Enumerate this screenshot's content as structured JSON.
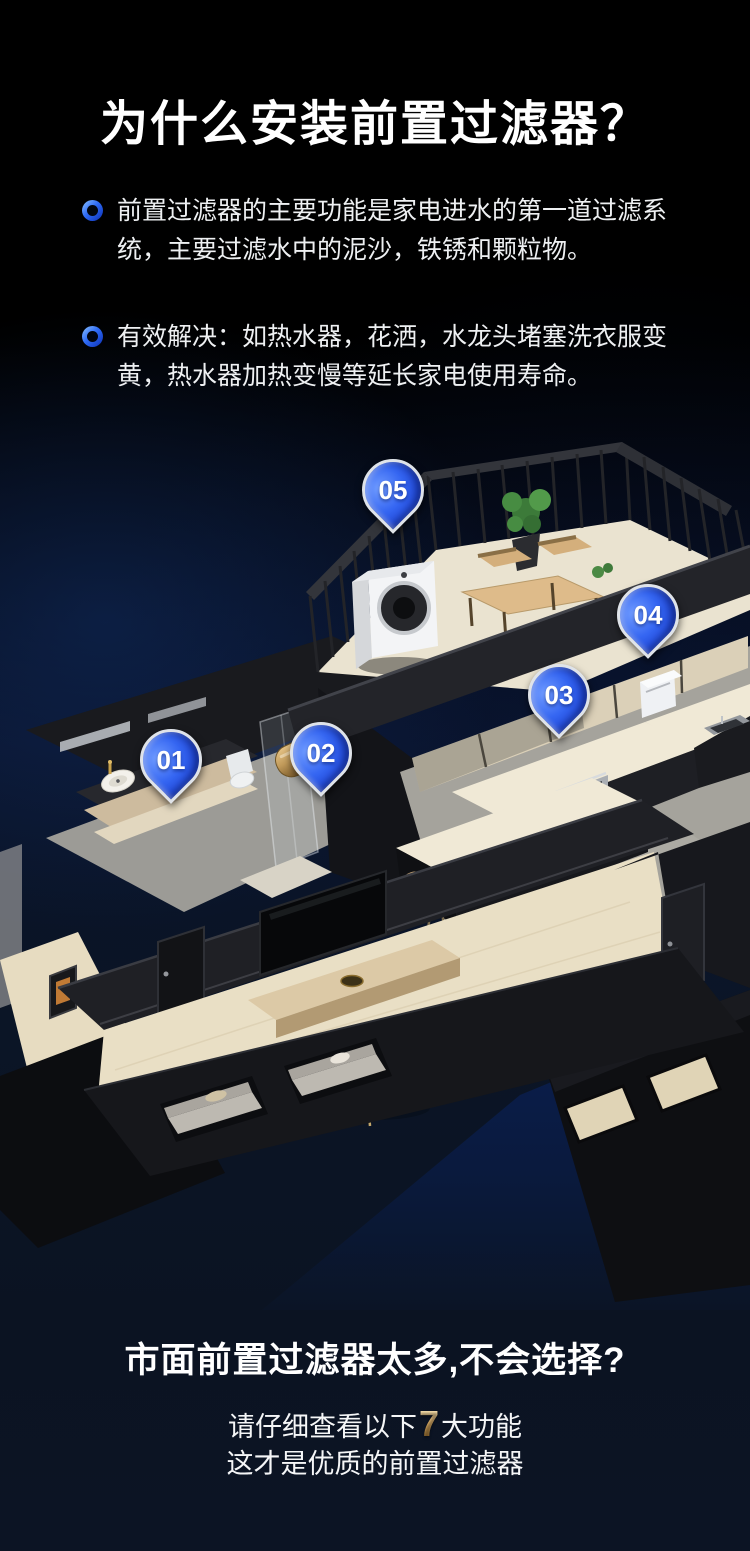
{
  "header": {
    "title": "为什么安装前置过滤器？"
  },
  "bullets": [
    {
      "text": "前置过滤器的主要功能是家电进水的第一道过滤系统，主要过滤水中的泥沙，铁锈和颗粒物。"
    },
    {
      "text": "有效解决：如热水器，花洒，水龙头堵塞洗衣服变黄，热水器加热变慢等延长家电使用寿命。"
    }
  ],
  "diagram": {
    "pins": [
      {
        "label": "01"
      },
      {
        "label": "02"
      },
      {
        "label": "03"
      },
      {
        "label": "04"
      },
      {
        "label": "05"
      }
    ],
    "pin_color": "#2a5cf0"
  },
  "footer": {
    "headline": "市面前置过滤器太多,不会选择?",
    "line2_prefix": "请仔细查看以下",
    "line2_number": "7",
    "line2_suffix": "大功能",
    "line3": "这才是优质的前置过滤器",
    "number_color": "#d9a556"
  }
}
